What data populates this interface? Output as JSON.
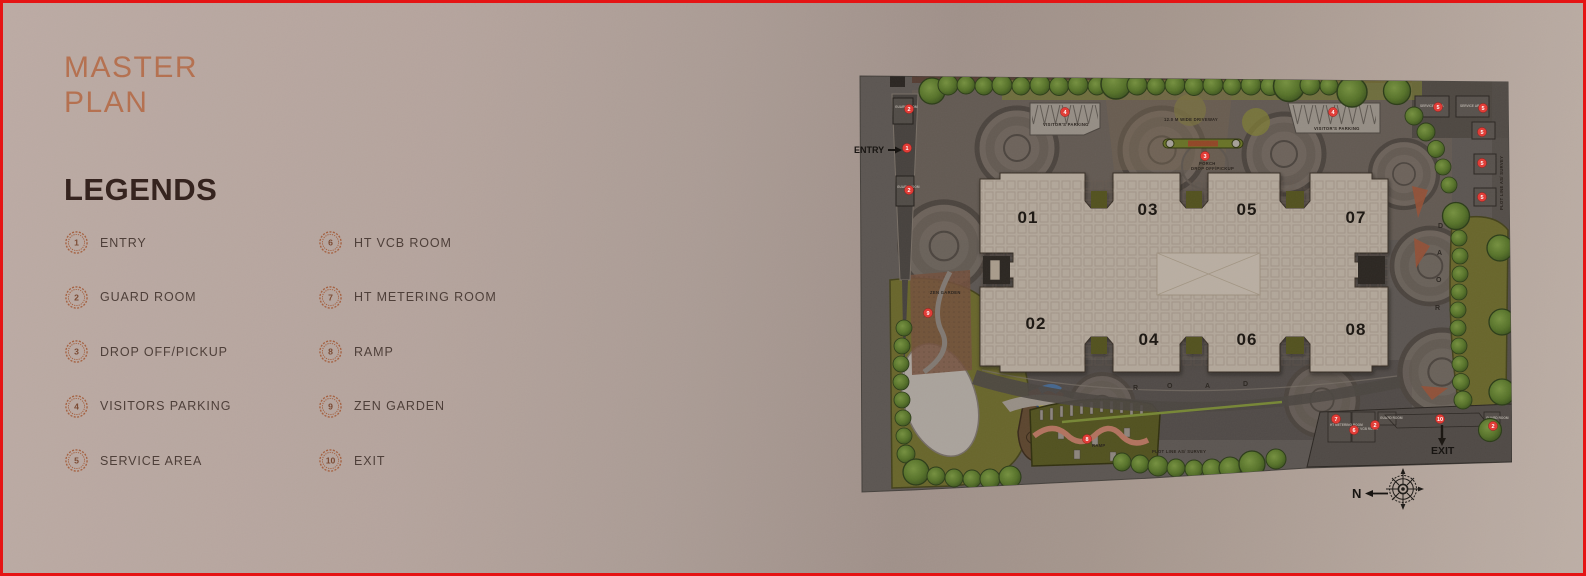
{
  "page": {
    "title_line1": "MASTER",
    "title_line2": "PLAN"
  },
  "legends": {
    "heading": "LEGENDS",
    "items": [
      {
        "num": "1",
        "label": "ENTRY"
      },
      {
        "num": "2",
        "label": "GUARD ROOM"
      },
      {
        "num": "3",
        "label": "DROP OFF/PICKUP"
      },
      {
        "num": "4",
        "label": "VISITORS PARKING"
      },
      {
        "num": "5",
        "label": "SERVICE AREA"
      },
      {
        "num": "6",
        "label": "HT VCB ROOM"
      },
      {
        "num": "7",
        "label": "HT METERING ROOM"
      },
      {
        "num": "8",
        "label": "RAMP"
      },
      {
        "num": "9",
        "label": "ZEN  GARDEN"
      },
      {
        "num": "10",
        "label": "EXIT"
      }
    ]
  },
  "plan": {
    "towers": [
      "01",
      "02",
      "03",
      "04",
      "05",
      "06",
      "07",
      "08"
    ],
    "labels": {
      "entry": "ENTRY",
      "exit": "EXIT",
      "north": "N",
      "visitors_parking": "VISITOR'S PARKING",
      "ramp": "RAMP",
      "zen_garden": "ZEN GARDEN",
      "porch": "PORCH",
      "drop_off": "DROP OFF/PICKUP",
      "driveway": "12.0 M WIDE DRIVEWAY",
      "plot_line": "PLOT LINE AS/ SURVEY",
      "plot_line_short": "PLOT LINE",
      "guard_room": "GUARD ROOM",
      "service_area": "SERVICE AREA",
      "ht_metering": "HT METERING ROOM",
      "ht_vcb": "HT VCB ROOM",
      "road_letters": [
        "R",
        "O",
        "A",
        "D"
      ]
    },
    "markers": [
      {
        "n": "2"
      },
      {
        "n": "1"
      },
      {
        "n": "2"
      },
      {
        "n": "4"
      },
      {
        "n": "3"
      },
      {
        "n": "4"
      },
      {
        "n": "5"
      },
      {
        "n": "5"
      },
      {
        "n": "5"
      },
      {
        "n": "5"
      },
      {
        "n": "5"
      },
      {
        "n": "9"
      },
      {
        "n": "8"
      },
      {
        "n": "7"
      },
      {
        "n": "6"
      },
      {
        "n": "2"
      },
      {
        "n": "10"
      },
      {
        "n": "2"
      }
    ]
  },
  "colors": {
    "accent": "#b5704f",
    "heading": "#33211c",
    "border": "#e51414",
    "marker": "#e23b35",
    "plan_bg": "#6b6663",
    "building": "#d9cdbf",
    "tree": "#5e8030",
    "olive": "#7b7a33"
  }
}
